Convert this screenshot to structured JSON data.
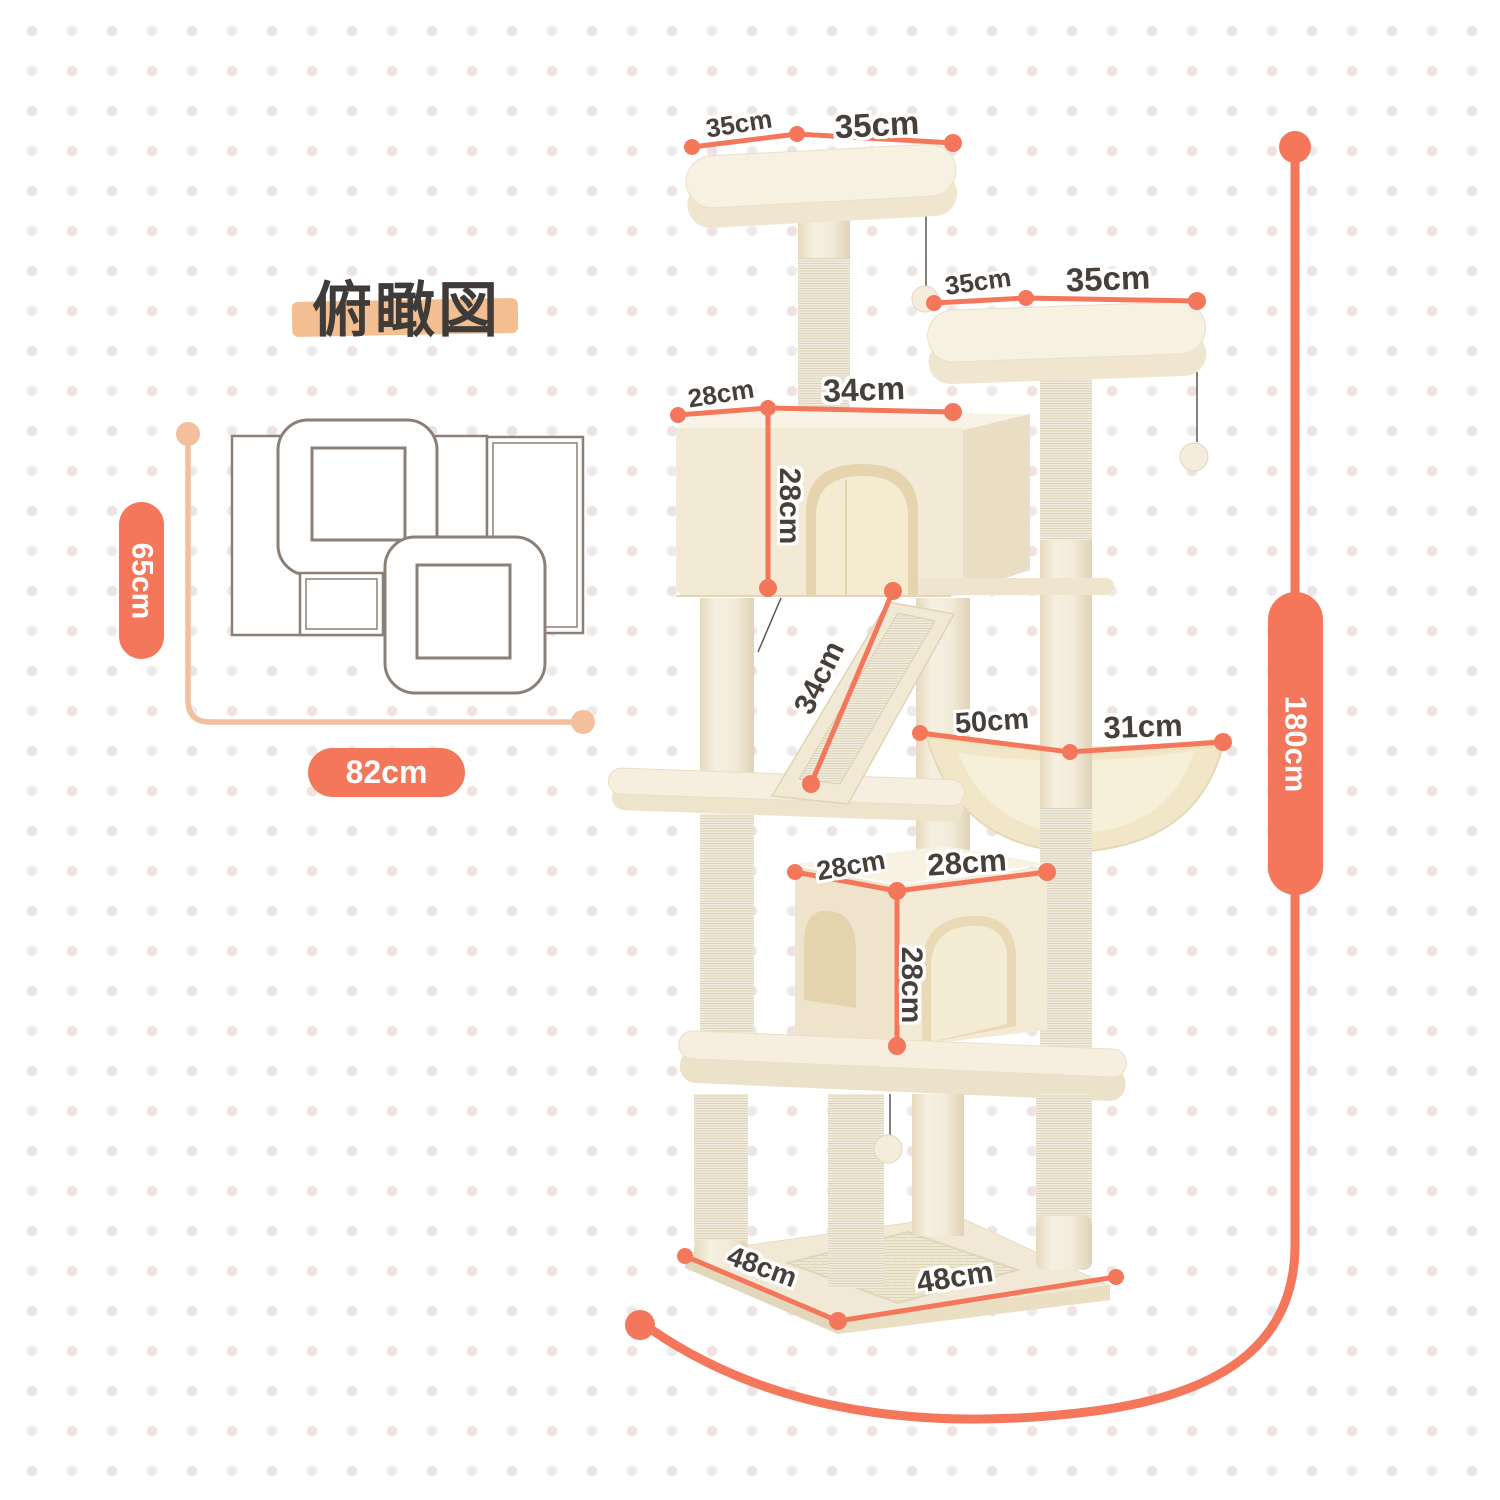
{
  "title": "俯瞰図",
  "colors": {
    "accent": "#F4775B",
    "accent_light": "#F3BF9C",
    "title_highlight": "#F2BE92",
    "label_text": "#47403A",
    "diagram_outline": "#8B8077",
    "plush": "#F3EBD9"
  },
  "overhead_view": {
    "depth_label": "65cm",
    "width_label": "82cm"
  },
  "tree": {
    "height_label": "180cm",
    "top_platform": {
      "edge_left": "35cm",
      "edge_right": "35cm"
    },
    "second_platform": {
      "edge_left": "35cm",
      "edge_right": "35cm"
    },
    "upper_condo": {
      "depth": "28cm",
      "width": "34cm",
      "height": "28cm"
    },
    "ramp": {
      "length": "34cm"
    },
    "hammock": {
      "width": "50cm",
      "depth": "31cm"
    },
    "lower_condo": {
      "depth": "28cm",
      "width": "28cm",
      "height": "28cm"
    },
    "base": {
      "edge_left": "48cm",
      "edge_right": "48cm"
    }
  }
}
